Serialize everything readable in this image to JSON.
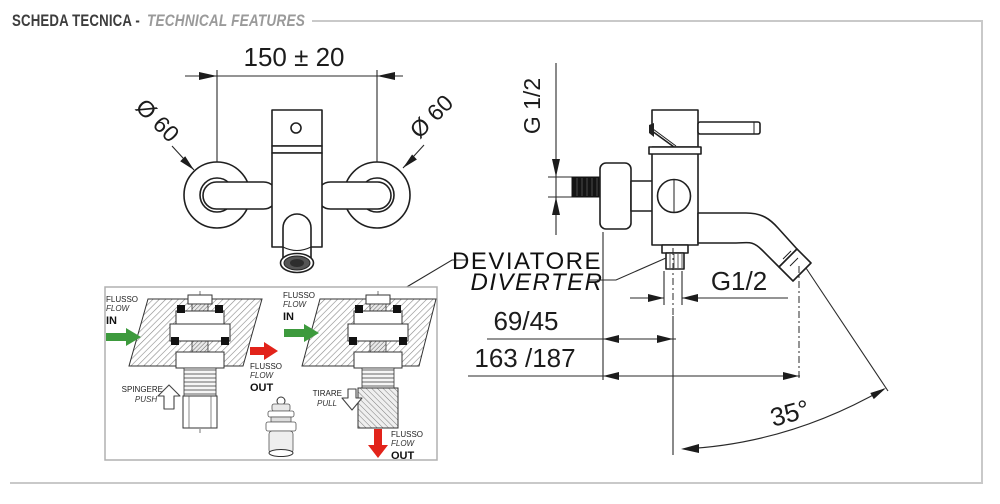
{
  "header": {
    "title_primary": "SCHEDA TECNICA -",
    "title_secondary": "TECHNICAL FEATURES"
  },
  "front_view": {
    "width_dimension": "150 ± 20",
    "left_flange_diameter": "Ø 60",
    "right_flange_diameter": "Ø 60"
  },
  "side_view": {
    "inlet_thread": "G 1/2",
    "diverter_it": "DEVIATORE",
    "diverter_en": "DIVERTER",
    "diverter_thread": "G1/2",
    "wall_to_center_depth": "69/45",
    "wall_to_spout_depth": "163 /187",
    "spout_angle": "35°"
  },
  "diverter_inset": {
    "push_mode": {
      "in_line1": "FLUSSO",
      "in_line2": "FLOW",
      "in_line3": "IN",
      "action_line1": "SPINGERE",
      "action_line2": "PUSH",
      "out_line1": "FLUSSO",
      "out_line2": "FLOW",
      "out_line3": "OUT"
    },
    "pull_mode": {
      "in_line1": "FLUSSO",
      "in_line2": "FLOW",
      "in_line3": "IN",
      "action_line1": "TIRARE",
      "action_line2": "PULL",
      "out_line1": "FLUSSO",
      "out_line2": "FLOW",
      "out_line3": "OUT"
    }
  },
  "colors": {
    "flow_in": "#3d9a3d",
    "flow_out": "#e2231a",
    "drawing_line": "#1f1f1f",
    "frame": "#c9c9c9"
  }
}
